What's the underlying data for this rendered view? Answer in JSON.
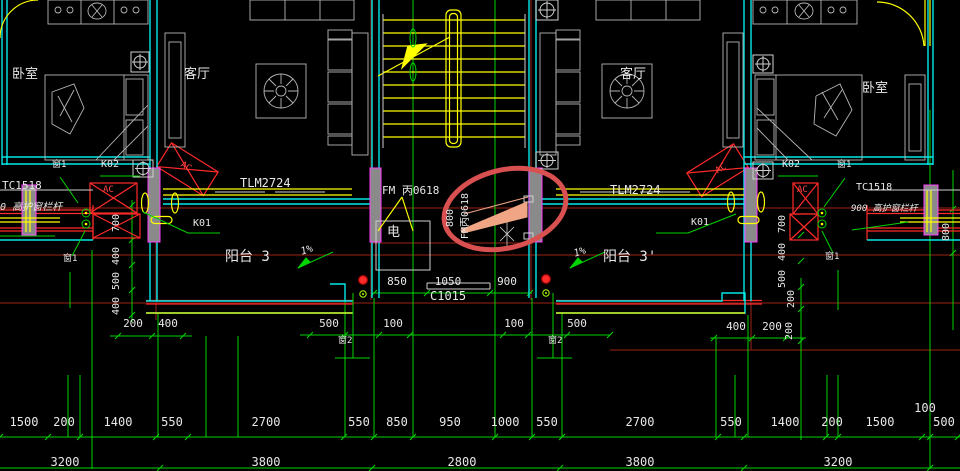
{
  "labels": {
    "bedroom": "卧室",
    "living_room": "客厅",
    "balcony_left": "阳台 3",
    "balcony_right": "阳台 3'",
    "slope": "1%",
    "electric_shaft": "电",
    "balcony_door": "TLM2724",
    "fire_door": "FM 丙0618",
    "fire_door_rotated": "FM丙0618",
    "fire_door_width": "800",
    "window_c1015": "C1015",
    "bay_window": "TC1518",
    "rail_note": "900 高护窗栏杆",
    "window_1": "窗1",
    "window_2": "窗2",
    "mark_k01": "K01",
    "mark_k02": "K02",
    "ac_unit": "AC"
  },
  "dims": {
    "center_window": [
      "850",
      "1050",
      "900"
    ],
    "mid_row": [
      "500",
      "100",
      "100",
      "500"
    ],
    "left_column": [
      "700",
      "400",
      "500",
      "400"
    ],
    "left_pair": [
      "200",
      "400"
    ],
    "right_column": [
      "700",
      "400",
      "500"
    ],
    "right_column_outer": [
      "200",
      "200"
    ],
    "right_pair": [
      "400",
      "200"
    ],
    "right_edge": "800",
    "row1": [
      "1500",
      "200",
      "1400",
      "550",
      "2700",
      "550",
      "850",
      "950",
      "1000",
      "550",
      "2700",
      "550",
      "1400",
      "200",
      "1500",
      "500"
    ],
    "row1_upper": "100",
    "row2": [
      "3200",
      "3800",
      "2800",
      "3800",
      "3200"
    ]
  },
  "colors": {
    "wall_cyan": "#00e8e8",
    "axis_green": "#00d400",
    "window_yellow": "#ffff00",
    "beam_dark_red": "#7c1d12",
    "bright_red": "#ff2a2a",
    "column_magenta": "#ff3dff",
    "highlight_ellipse": "#d85050",
    "highlight_door_fill": "#f0a585",
    "text_white": "#e8e8e8"
  }
}
